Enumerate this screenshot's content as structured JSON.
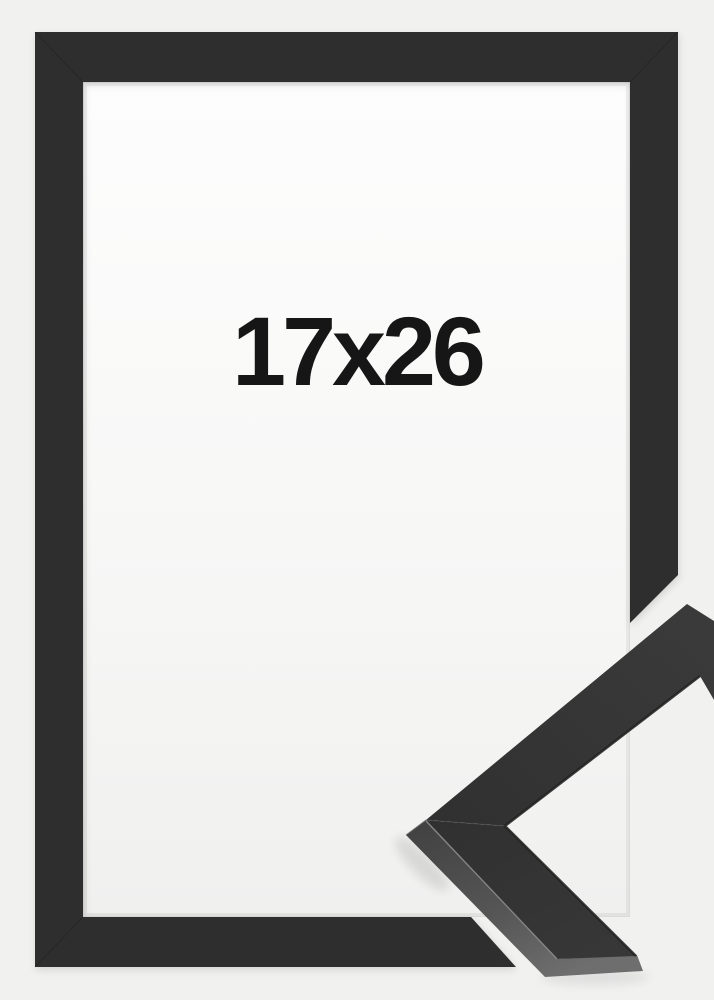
{
  "product": {
    "size_label": "17x26"
  },
  "colors": {
    "background": "#f1f1f0",
    "frame": "#2e2e2e",
    "sample_top_face": "#363636",
    "sample_side_face": "#585858",
    "paper": "#fbfbfb",
    "label_text": "#161616"
  }
}
